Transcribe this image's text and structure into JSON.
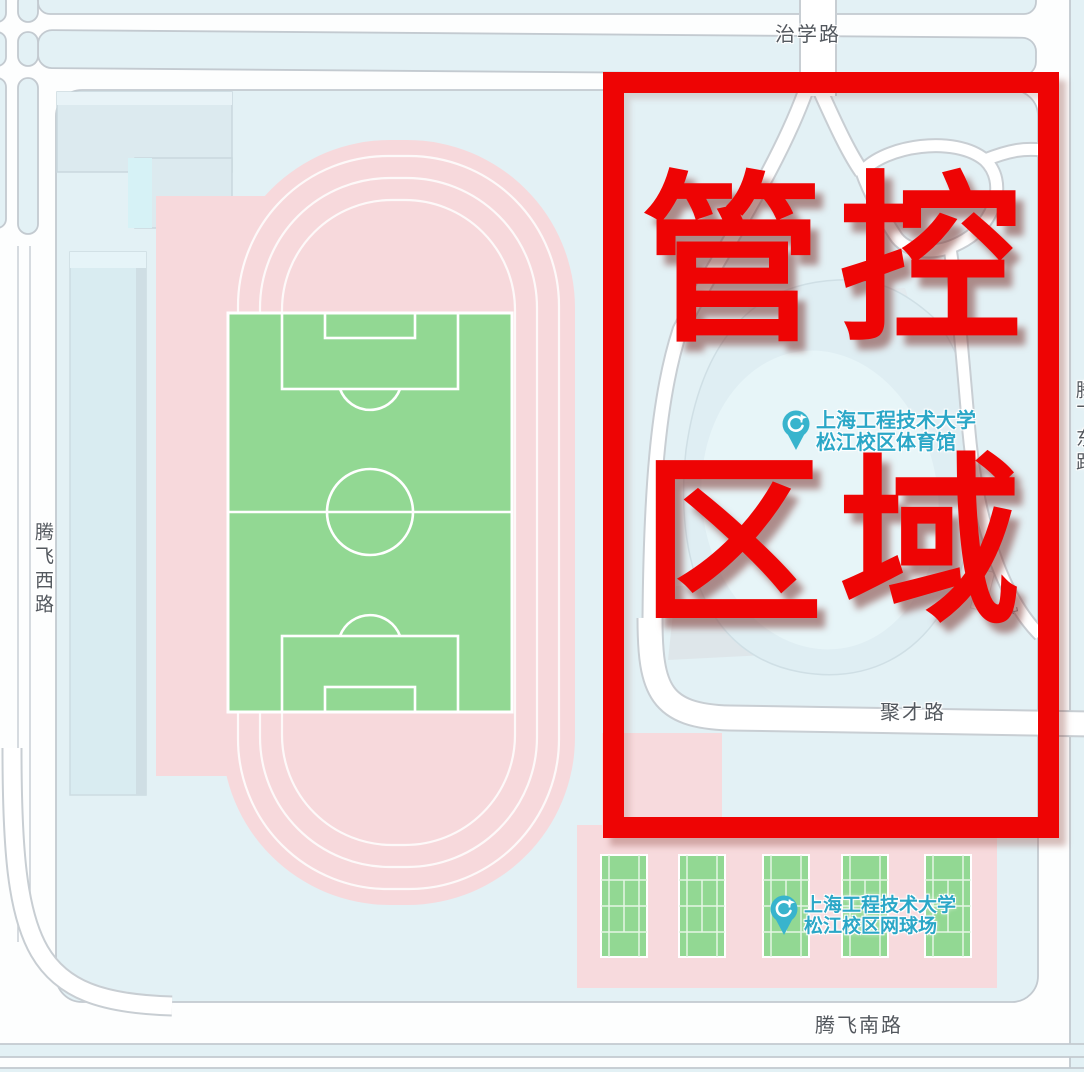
{
  "map": {
    "road_labels": {
      "north": "治学路",
      "west": "腾飞西路",
      "middle": "聚才路",
      "south": "腾飞南路",
      "east_clipped": "腾飞东路"
    },
    "pois": {
      "gym": {
        "line1": "上海工程技术大学",
        "line2": "松江校区体育馆",
        "icon": "sports-venue-pin"
      },
      "tennis": {
        "line1": "上海工程技术大学",
        "line2": "松江校区网球场",
        "icon": "sports-venue-pin"
      }
    },
    "entrance_mark_glyph": "↵",
    "colors": {
      "background_blue": "#e3f1f5",
      "road_white": "#ffffff",
      "road_casing": "#c3cad0",
      "track_pink": "#f7d9dc",
      "pitch_green": "#92d893",
      "poi_teal": "#2ba7c7",
      "pin_teal": "#38b4cd",
      "road_label_gray": "#53585e"
    }
  },
  "overlay": {
    "line1": "管控",
    "line2": "区域",
    "color": "#ee0404"
  }
}
